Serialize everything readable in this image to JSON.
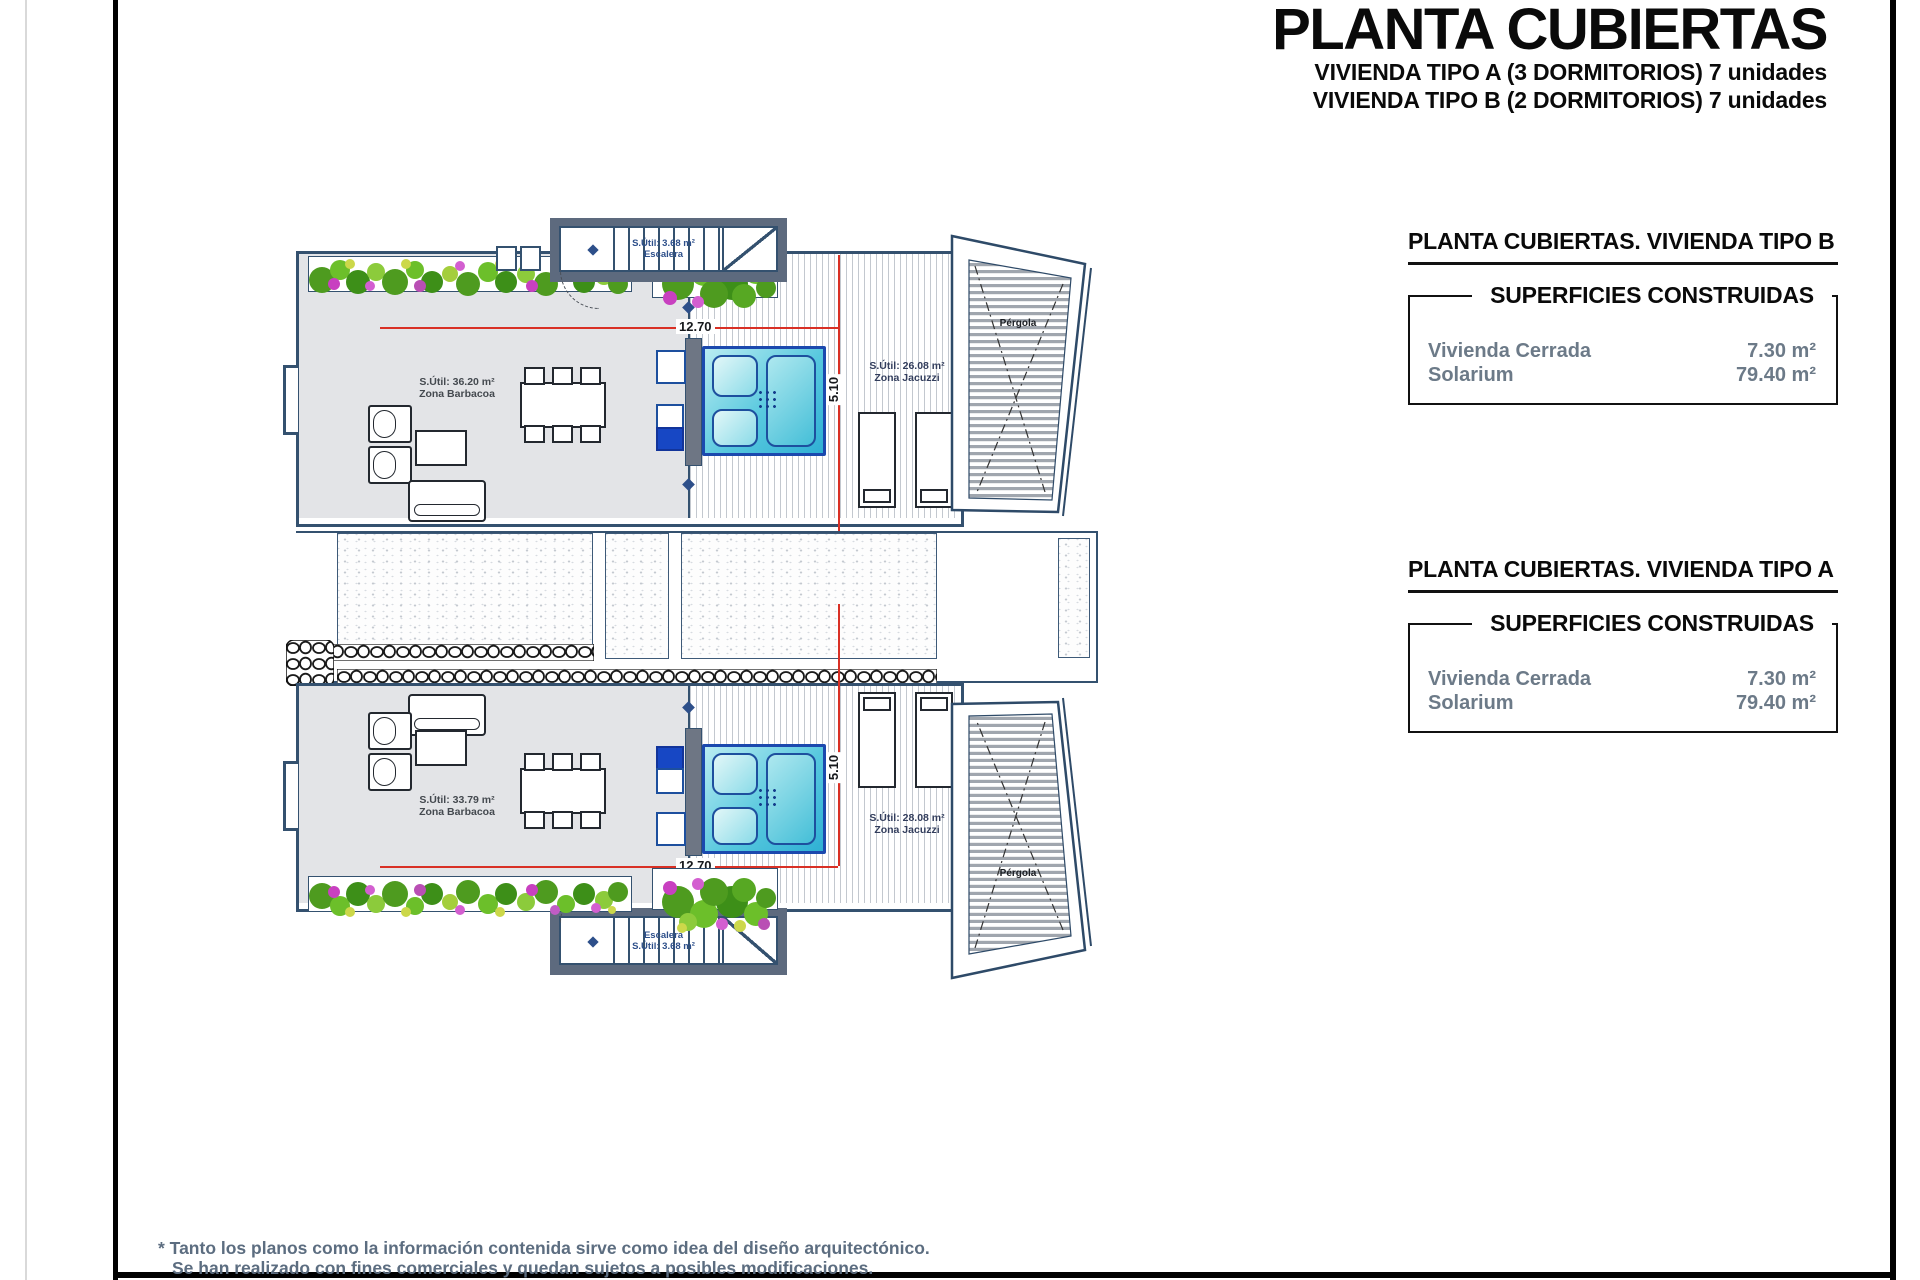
{
  "header": {
    "title": "PLANTA CUBIERTAS",
    "subtitle_a": "VIVIENDA TIPO A (3 DORMITORIOS) 7 unidades",
    "subtitle_b": "VIVIENDA TIPO B (2 DORMITORIOS) 7 unidades"
  },
  "info_boxes": [
    {
      "heading": "PLANTA CUBIERTAS. VIVIENDA TIPO B",
      "subheading": "SUPERFICIES CONSTRUIDAS",
      "rows": [
        {
          "label": "Vivienda Cerrada",
          "value": "7.30 m²"
        },
        {
          "label": "Solarium",
          "value": "79.40 m²"
        }
      ]
    },
    {
      "heading": "PLANTA CUBIERTAS. VIVIENDA TIPO A",
      "subheading": "SUPERFICIES CONSTRUIDAS",
      "rows": [
        {
          "label": "Vivienda Cerrada",
          "value": "7.30 m²"
        },
        {
          "label": "Solarium",
          "value": "79.40 m²"
        }
      ]
    }
  ],
  "plan": {
    "unit_b": {
      "stair_area": "S.Útil: 3.68 m²",
      "stair_label": "Escalera",
      "barbecue_area": "S.Útil: 36.20 m²",
      "barbecue_label": "Zona Barbacoa",
      "jacuzzi_area": "S.Útil: 26.08 m²",
      "jacuzzi_label": "Zona Jacuzzi",
      "pergola_label": "Pérgola",
      "dim_width": "12.70",
      "dim_depth": "5.10"
    },
    "unit_a": {
      "stair_area": "S.Útil: 3.68 m²",
      "stair_label": "Escalera",
      "barbecue_area": "S.Útil: 33.79 m²",
      "barbecue_label": "Zona Barbacoa",
      "jacuzzi_area": "S.Útil: 28.08 m²",
      "jacuzzi_label": "Zona Jacuzzi",
      "pergola_label": "Pérgola",
      "dim_width": "12.70",
      "dim_depth": "5.10"
    }
  },
  "footnote": {
    "line1": "* Tanto los planos como la información contenida sirve como idea del diseño arquitectónico.",
    "line2": "Se han realizado con fines comerciales y quedan sujetos a posibles modificaciones."
  },
  "colors": {
    "outline_navy": "#34516f",
    "wall_slate": "#5d6a7e",
    "floor_gray": "#e3e4e7",
    "dimension_red": "#d93025",
    "jacuzzi_blue": "#1b49ae",
    "fixture_blue": "#1747c4",
    "note_gray": "#5c6d80"
  }
}
